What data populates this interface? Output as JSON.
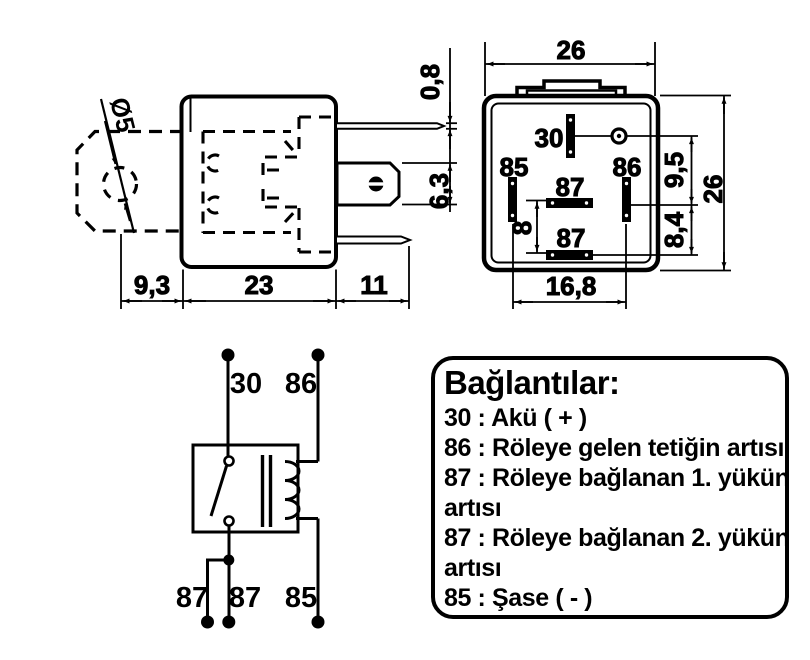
{
  "colors": {
    "ink": "#000000",
    "background": "#ffffff"
  },
  "side_view": {
    "hole_dia": "Ø5",
    "dim_tab_width": "9,3",
    "dim_body_width": "23",
    "dim_pin_length": "11",
    "dim_pin_thickness": "0,8",
    "dim_blade_width": "6,3"
  },
  "bottom_view": {
    "dim_width": "26",
    "dim_height": "26",
    "dim_30_to_86": "9,5",
    "dim_86_to_87": "8,4",
    "dim_87_gap": "8",
    "dim_85_to_86_span": "16,8",
    "pin_30": "30",
    "pin_85": "85",
    "pin_86": "86",
    "pin_87_top": "87",
    "pin_87_bottom": "87"
  },
  "schematic": {
    "label_30": "30",
    "label_86": "86",
    "label_87_left": "87",
    "label_87_mid": "87",
    "label_85": "85"
  },
  "legend": {
    "title": "Bağlantılar:",
    "rows": [
      "30 : Akü ( + )",
      "86 : Röleye gelen tetiğin artısı",
      "87 : Röleye bağlanan 1. yükün",
      "artısı",
      "87 : Röleye bağlanan 2. yükün",
      "artısı",
      "85 : Şase ( - )"
    ]
  }
}
